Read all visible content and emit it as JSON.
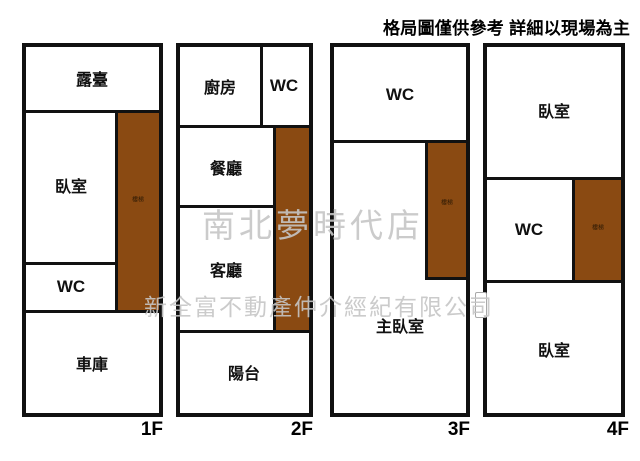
{
  "disclaimer": "格局圖僅供參考 詳細以現場為主",
  "watermark": {
    "store": "南北夢時代店",
    "company": "新全富不動產仲介經紀有限公司"
  },
  "stairs_label": "樓梯",
  "colors": {
    "stairs_fill": "#8a4a12",
    "wall": "#111111",
    "watermark_gray": "#c5c5c5"
  },
  "floors": {
    "f1": {
      "label": "1F",
      "rooms": {
        "terrace": "露臺",
        "bedroom": "臥室",
        "wc": "WC",
        "garage": "車庫"
      }
    },
    "f2": {
      "label": "2F",
      "rooms": {
        "kitchen": "廚房",
        "wc": "WC",
        "dining": "餐廳",
        "living": "客廳",
        "balcony": "陽台"
      }
    },
    "f3": {
      "label": "3F",
      "rooms": {
        "wc": "WC",
        "master_bedroom": "主臥室"
      }
    },
    "f4": {
      "label": "4F",
      "rooms": {
        "bedroom_top": "臥室",
        "wc": "WC",
        "bedroom_bottom": "臥室"
      }
    }
  }
}
